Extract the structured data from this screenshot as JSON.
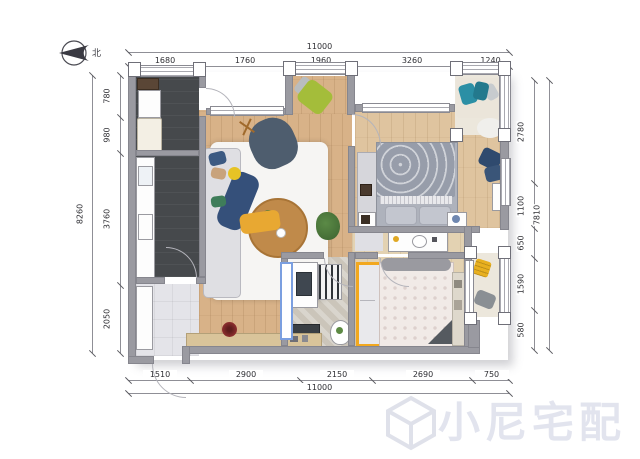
{
  "north": {
    "label": "北"
  },
  "watermark": {
    "text": "小尼宅配"
  },
  "dimensions": {
    "top": {
      "total": "11000",
      "segments": [
        {
          "label": "1680",
          "from": 128,
          "to": 200
        },
        {
          "label": "1760",
          "from": 200,
          "to": 288
        },
        {
          "label": "1960",
          "from": 288,
          "to": 352
        },
        {
          "label": "3260",
          "from": 352,
          "to": 470
        },
        {
          "label": "1240",
          "from": 470,
          "to": 509
        }
      ]
    },
    "bottom": {
      "total": "11000",
      "segments": [
        {
          "label": "1510",
          "from": 128,
          "to": 190
        },
        {
          "label": "2900",
          "from": 190,
          "to": 300
        },
        {
          "label": "2150",
          "from": 300,
          "to": 372
        },
        {
          "label": "2690",
          "from": 372,
          "to": 472
        },
        {
          "label": "750",
          "from": 472,
          "to": 509
        }
      ]
    },
    "left": {
      "total": "8260",
      "segments": [
        {
          "label": "780",
          "from": 75,
          "to": 117
        },
        {
          "label": "980",
          "from": 117,
          "to": 153
        },
        {
          "label": "3760",
          "from": 153,
          "to": 285
        },
        {
          "label": "2050",
          "from": 285,
          "to": 353
        }
      ]
    },
    "right": {
      "total": "7810",
      "segments": [
        {
          "label": "2780",
          "from": 80,
          "to": 183
        },
        {
          "label": "1100",
          "from": 183,
          "to": 228
        },
        {
          "label": "650",
          "from": 228,
          "to": 258
        },
        {
          "label": "1590",
          "from": 258,
          "to": 310
        },
        {
          "label": "580",
          "from": 310,
          "to": 350
        }
      ]
    }
  },
  "colors": {
    "wall": "#9a9aa1",
    "dark_floor": "#46494c",
    "wood_floor": "#d8b288",
    "accent_yellow": "#f0a81e",
    "accent_blue": "#7b9fe0",
    "accent_teal": "#2b8fa5",
    "sofa_navy": "#3c5a82",
    "green_chair": "#a4bd3a",
    "watermark_gray": "#e2e4ee"
  }
}
